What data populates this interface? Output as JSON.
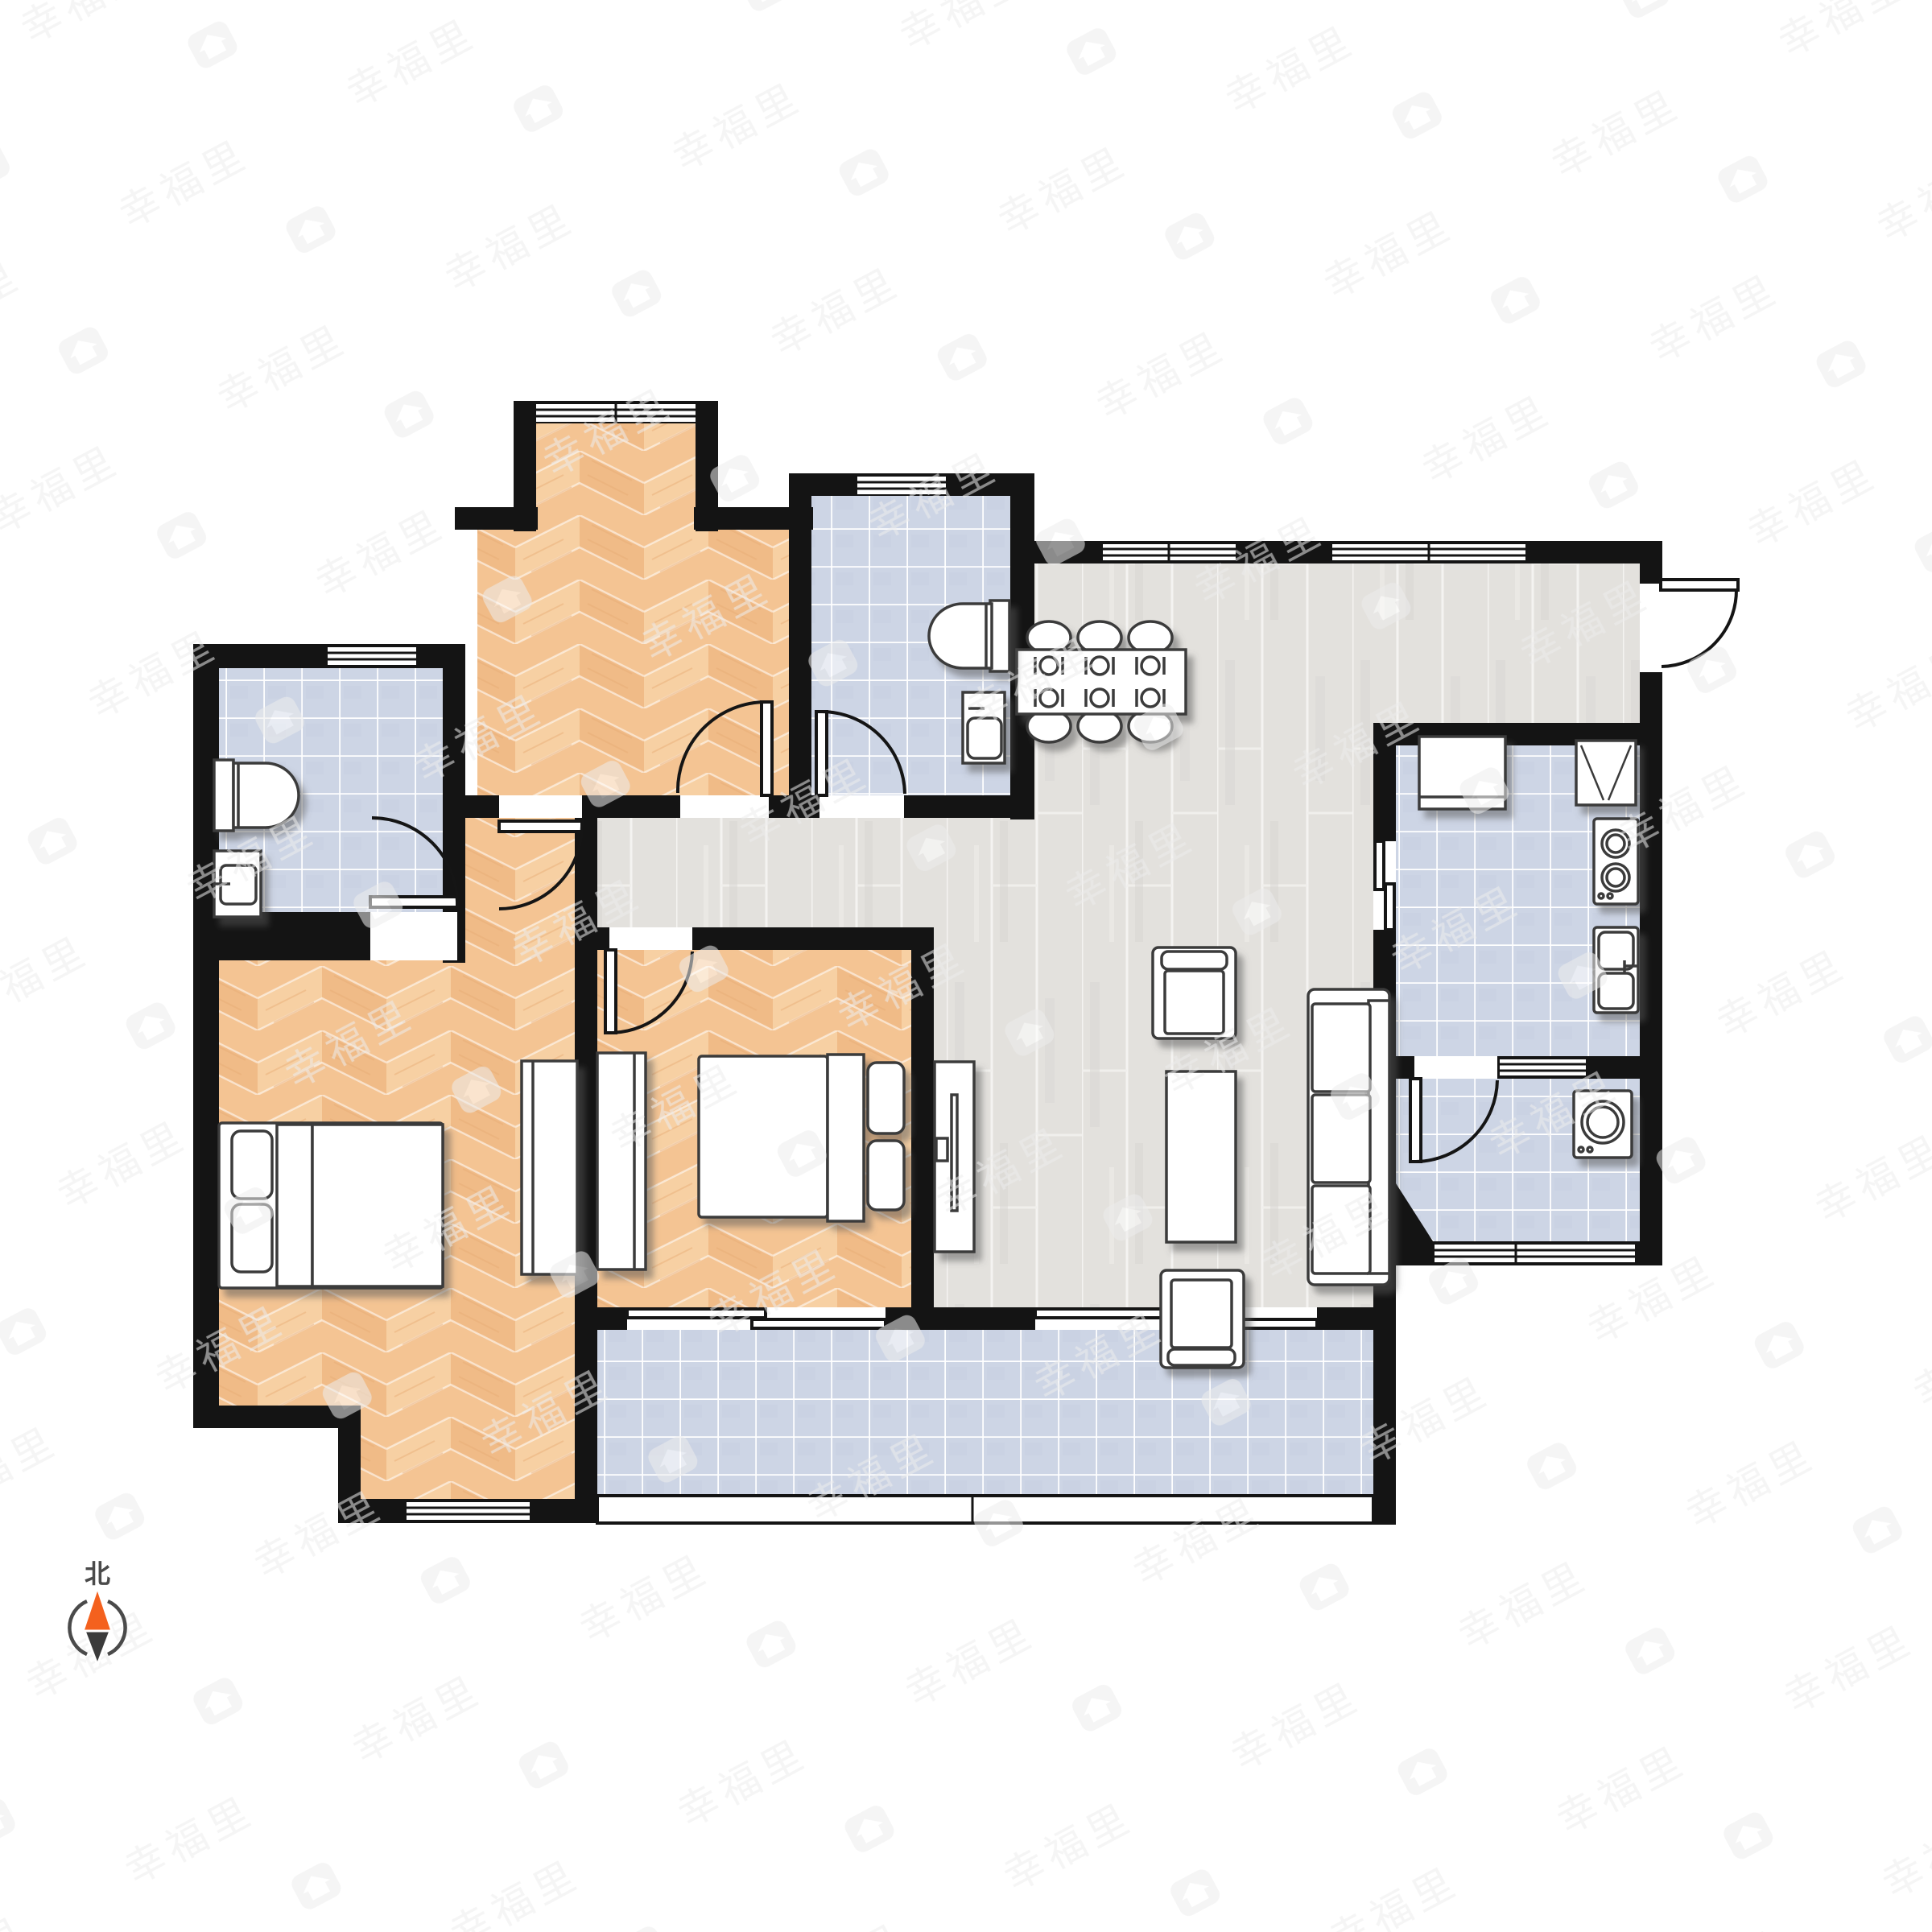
{
  "compass": {
    "label": "北",
    "icon": "compass-needle-icon",
    "north_color": "#f4611e",
    "south_color": "#3b3b3b",
    "ring_color": "#4a4a4a",
    "label_color": "#4a4a4a"
  },
  "watermark": {
    "text": "幸福里",
    "icon": "home-badge-icon",
    "color": "#ececec"
  },
  "palette": {
    "wall": "#141414",
    "furniture_stroke": "#3a3a3a",
    "wood_base": "#f4c493",
    "wood_light": "#f8d3a6",
    "wood_dark": "#eeb882",
    "gray_floor": "#e3e1dd",
    "gray_seam": "#f4f3f1",
    "tile_base": "#cdd5e5",
    "tile_grid": "#ffffff",
    "door_line": "#151515"
  },
  "floorplan": {
    "rooms": [
      {
        "id": "bedroom-top",
        "floor": "herringbone-wood",
        "features": [
          "bay-window"
        ]
      },
      {
        "id": "bathroom-top",
        "floor": "blue-tile",
        "fixtures": [
          "toilet",
          "wash-basin"
        ]
      },
      {
        "id": "bathroom-left",
        "floor": "blue-tile",
        "fixtures": [
          "toilet",
          "wash-basin"
        ]
      },
      {
        "id": "bedroom-left",
        "floor": "herringbone-wood",
        "fixtures": [
          "double-bed",
          "wardrobe"
        ]
      },
      {
        "id": "bedroom-middle",
        "floor": "herringbone-wood",
        "fixtures": [
          "double-bed",
          "wardrobe"
        ]
      },
      {
        "id": "living-dining",
        "floor": "gray-plank",
        "fixtures": [
          "dining-table",
          "six-chairs",
          "tv-cabinet",
          "sofa",
          "armchairs",
          "coffee-table"
        ]
      },
      {
        "id": "kitchen",
        "floor": "blue-tile",
        "fixtures": [
          "counter",
          "fridge",
          "stove",
          "double-sink"
        ]
      },
      {
        "id": "bathroom-small",
        "floor": "blue-tile",
        "fixtures": [
          "washing-machine"
        ]
      },
      {
        "id": "balcony",
        "floor": "blue-tile",
        "features": [
          "railing"
        ]
      }
    ],
    "doors": [
      "entry-door-right",
      "top-bedroom-door",
      "top-bathroom-door",
      "corridor-door",
      "left-bathroom-door",
      "middle-bedroom-door",
      "small-bathroom-door",
      "kitchen-sliding-door",
      "balcony-sliding-door-1",
      "balcony-sliding-door-2"
    ],
    "windows": [
      "bay-window",
      "left-bathroom-window",
      "top-bathroom-window",
      "dining-window-1",
      "dining-window-2",
      "kitchen-bath-window",
      "small-bathroom-bottom-window",
      "left-bedroom-bottom-window"
    ]
  }
}
